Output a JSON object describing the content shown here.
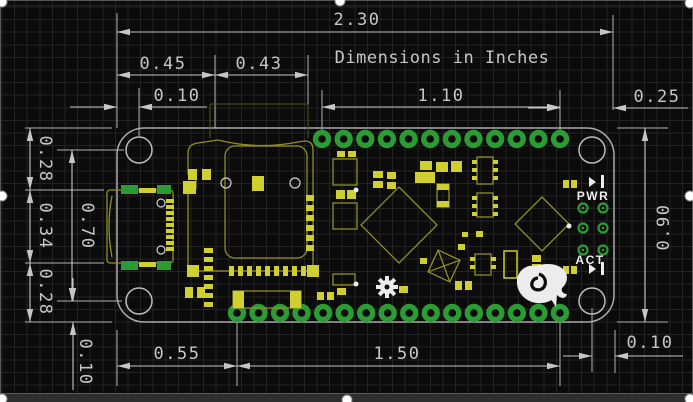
{
  "title": "Dimensions in Inches",
  "drawing": {
    "type": "pcb-dimension-drawing",
    "units": "inches",
    "dims": {
      "board_width": "2.30",
      "usb_span": "0.45",
      "sd_span": "0.43",
      "hole_inset_top": "0.10",
      "top_pin_row": "1.10",
      "pin_to_edge_right": "0.25",
      "left_top": "0.28",
      "left_mid": "0.34",
      "left_bottom": "0.28",
      "hole_span_vertical": "0.70",
      "board_height": "0.90",
      "hole_inset_bottom": "0.10",
      "bottom_left_offset": "0.55",
      "bottom_pin_row": "1.50",
      "hole_inset_right": "0.10"
    },
    "silk": {
      "pwr": "PWR",
      "act": "ACT"
    },
    "pins": {
      "top": {
        "count": 12,
        "start_x": 322,
        "y": 139,
        "pitch": 21.64
      },
      "bottom": {
        "count": 16,
        "start_x": 237,
        "y": 313,
        "pitch": 21.53
      }
    },
    "led_pads": [
      [
        583,
        208
      ],
      [
        603,
        208
      ],
      [
        583,
        228
      ],
      [
        603,
        228
      ],
      [
        583,
        250
      ],
      [
        603,
        250
      ]
    ],
    "colors": {
      "background": "#0b0b0b",
      "grid": "#232323",
      "dimension": "#c6c6c6",
      "board_outline": "#aaaaaa",
      "pad_green": "#2a9c33",
      "silk_yellow": "#8f8f28",
      "silk_bright": "#cfcf30",
      "silk_white": "#ececec",
      "page_below": "#2e2e2e"
    }
  }
}
